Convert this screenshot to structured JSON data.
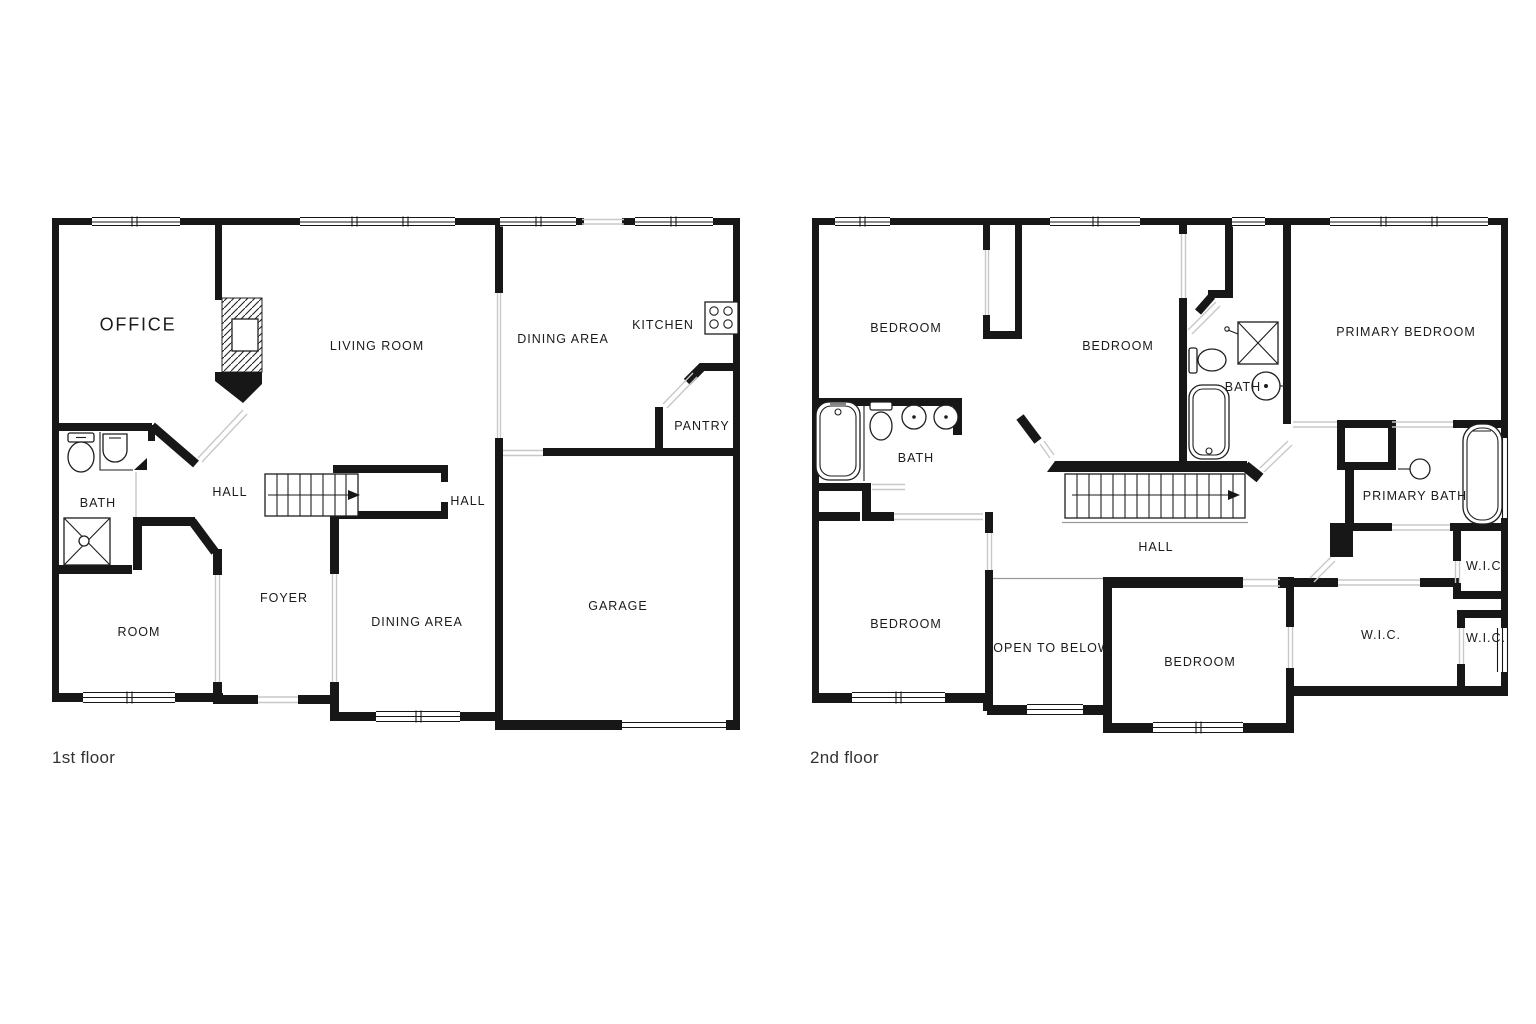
{
  "document": {
    "type": "floor-plan",
    "background": "#ffffff"
  },
  "colors": {
    "wall": "#171717",
    "label": "#1b1b1b",
    "opening_line": "#c8c8c8"
  },
  "floors": [
    {
      "caption": "1st floor",
      "rooms": {
        "office": "OFFICE",
        "living_room": "LIVING ROOM",
        "dining_area_upper": "DINING AREA",
        "kitchen": "KITCHEN",
        "pantry": "PANTRY",
        "bath": "BATH",
        "hall_upper": "HALL",
        "hall_lower": "HALL",
        "foyer": "FOYER",
        "room": "ROOM",
        "dining_area_lower": "DINING AREA",
        "garage": "GARAGE"
      },
      "fixtures": [
        "fireplace",
        "toilet",
        "sink",
        "shower",
        "stairs",
        "stove"
      ]
    },
    {
      "caption": "2nd floor",
      "rooms": {
        "bedroom_top_left": "BEDROOM",
        "bedroom_top_middle": "BEDROOM",
        "primary_bedroom": "PRIMARY BEDROOM",
        "bath_left": "BATH",
        "bath_middle": "BATH",
        "primary_bath": "PRIMARY BATH",
        "hall": "HALL",
        "bedroom_bottom_left": "BEDROOM",
        "open_to_below": "OPEN TO BELOW",
        "bedroom_bottom_middle": "BEDROOM",
        "wic_large": "W.I.C.",
        "wic_small_upper": "W.I.C.",
        "wic_small_lower": "W.I.C."
      },
      "fixtures": [
        "bathtub",
        "toilet",
        "sink",
        "shower",
        "stairs"
      ]
    }
  ]
}
